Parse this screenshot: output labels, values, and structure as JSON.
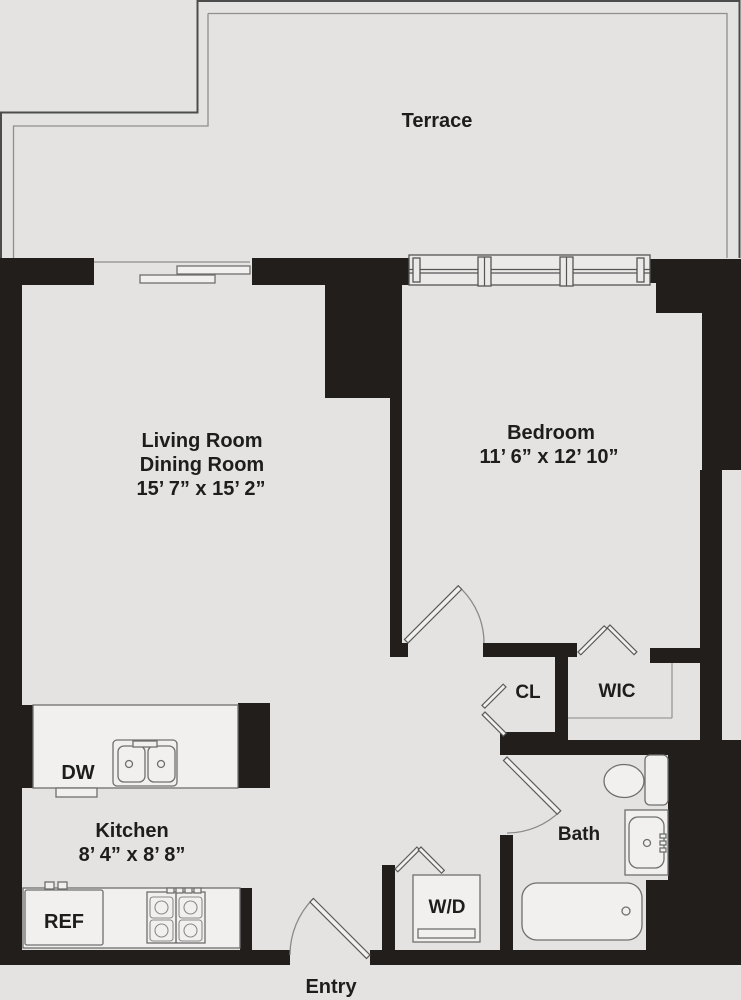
{
  "colors": {
    "background": "#e4e3e1",
    "wall": "#221e1c",
    "fixture_fill": "#f1f0ee",
    "text": "#1d1d1d"
  },
  "rooms": {
    "terrace": {
      "name": "Terrace"
    },
    "living": {
      "name": "Living Room",
      "name2": "Dining Room",
      "dims": "15’ 7” x 15’ 2”"
    },
    "bedroom": {
      "name": "Bedroom",
      "dims": "11’ 6” x 12’ 10”"
    },
    "kitchen": {
      "name": "Kitchen",
      "dims": "8’ 4” x 8’ 8”"
    },
    "bath": {
      "name": "Bath"
    },
    "wic": {
      "name": "WIC"
    },
    "closet": {
      "name": "CL"
    },
    "entry": {
      "name": "Entry"
    }
  },
  "fixtures": {
    "dishwasher": {
      "label": "DW"
    },
    "refrigerator": {
      "label": "REF"
    },
    "washer_dryer": {
      "label": "W/D"
    }
  }
}
